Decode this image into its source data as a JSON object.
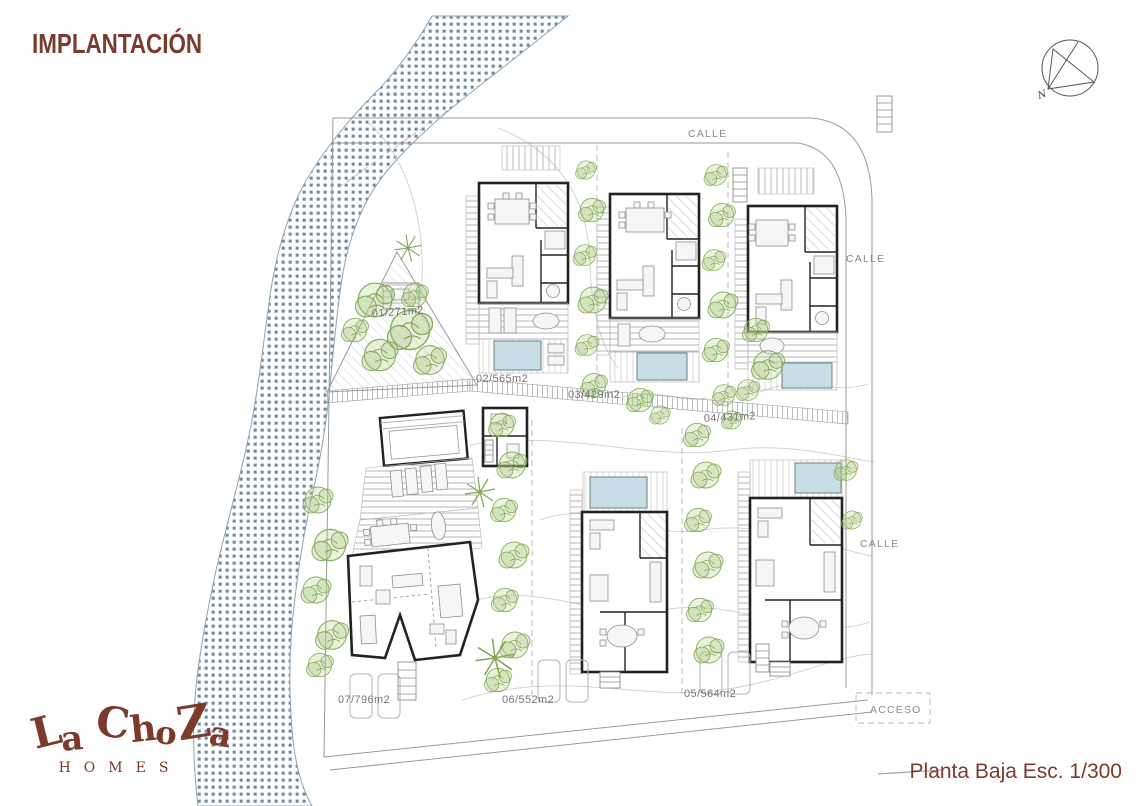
{
  "header": {
    "title": "IMPLANTACIÓN"
  },
  "compass": {
    "label": "N"
  },
  "logo": {
    "word": "La ChoZa",
    "subtitle": "HOMES"
  },
  "footer": {
    "scale_label": "Planta Baja Esc. 1/300"
  },
  "plan": {
    "streets": [
      {
        "id": "calle-top",
        "label": "CALLE"
      },
      {
        "id": "calle-right-upper",
        "label": "CALLE"
      },
      {
        "id": "calle-right-lower",
        "label": "CALLE"
      },
      {
        "id": "acceso",
        "label": "ACCESO"
      }
    ],
    "plots": [
      {
        "number": "01",
        "area_m2": 271,
        "label": "01/271m2"
      },
      {
        "number": "02",
        "area_m2": 565,
        "label": "02/565m2"
      },
      {
        "number": "03",
        "area_m2": 429,
        "label": "03/429m2"
      },
      {
        "number": "04",
        "area_m2": 431,
        "label": "04/431m2"
      },
      {
        "number": "05",
        "area_m2": 564,
        "label": "05/564m2"
      },
      {
        "number": "06",
        "area_m2": 552,
        "label": "06/552m2"
      },
      {
        "number": "07",
        "area_m2": 796,
        "label": "07/796m2"
      }
    ]
  },
  "colors": {
    "brand": "#7c3a2b",
    "river_dot": "#53778d",
    "vegetation": "#7fa855",
    "pool": "#c9dde6",
    "wall": "#222222",
    "line": "#8d8d8d"
  }
}
